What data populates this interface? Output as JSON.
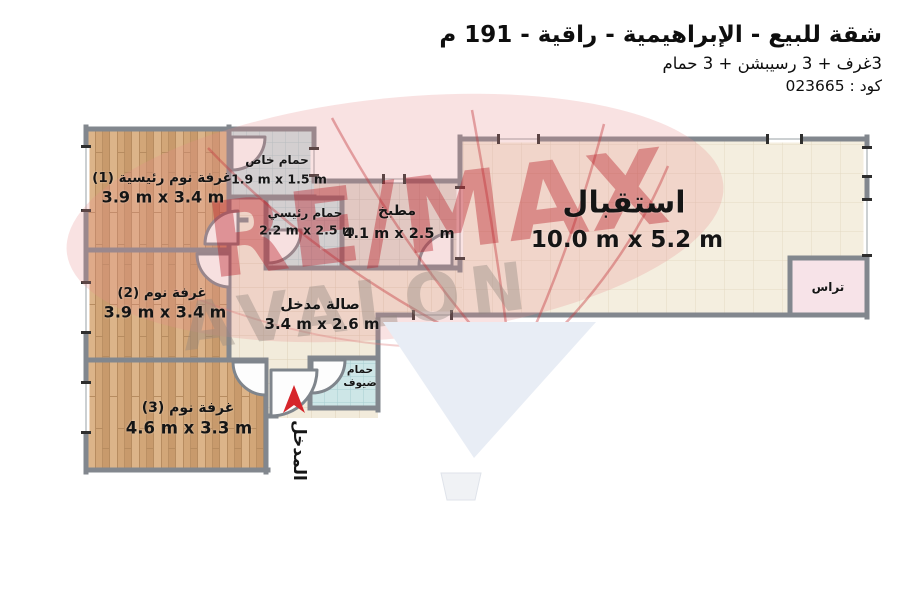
{
  "header": {
    "title": "شقة للبيع - الإبراهيمية  - راقية - 191 م",
    "subtitle": "3غرف + 3 رسيبشن + 3 حمام",
    "code": "كود : 023665"
  },
  "rooms": {
    "master_bedroom": {
      "name": "غرفة نوم رئيسية (1)",
      "dims": "3.9 m x 3.4 m"
    },
    "bedroom_2": {
      "name": "غرفة نوم (2)",
      "dims": "3.9 m x 3.4 m"
    },
    "bedroom_3": {
      "name": "غرفة نوم (3)",
      "dims": "4.6 m x 3.3 m"
    },
    "private_bath": {
      "name": "حمام خاص",
      "dims": "1.9 m x 1.5 m"
    },
    "master_bath": {
      "name": "حمام رئيسي",
      "dims": "2.2 m x 2.5 m"
    },
    "kitchen": {
      "name": "مطبخ",
      "dims": "4.1 m x 2.5 m"
    },
    "reception": {
      "name": "استقبال",
      "dims": "10.0 m x 5.2 m"
    },
    "entry_hall": {
      "name": "صالة مدخل",
      "dims": "3.4 m x 2.6 m"
    },
    "guest_bath": {
      "name_line1": "حمام",
      "name_line2": "ضيوف"
    },
    "terrace": {
      "name": "تراس"
    },
    "entrance": {
      "name": "المدخل"
    }
  },
  "watermark": {
    "brand_top": "RE/MAX",
    "brand_bottom": "AVALON"
  },
  "colors": {
    "wall_gray": "#82878e",
    "wood_floor": "#d5aa7e",
    "bath_tile": "#cde6e7",
    "hall_tile": "#f2ebdb",
    "kitchen_tile": "#e0ddd5",
    "reception_tile": "#f4eedf",
    "terrace_pink": "#f7e3e8",
    "entrance_arrow_red": "#d6252b",
    "watermark_red": "#b91e28",
    "balloon_bottom_blue": "#e8edf5"
  }
}
